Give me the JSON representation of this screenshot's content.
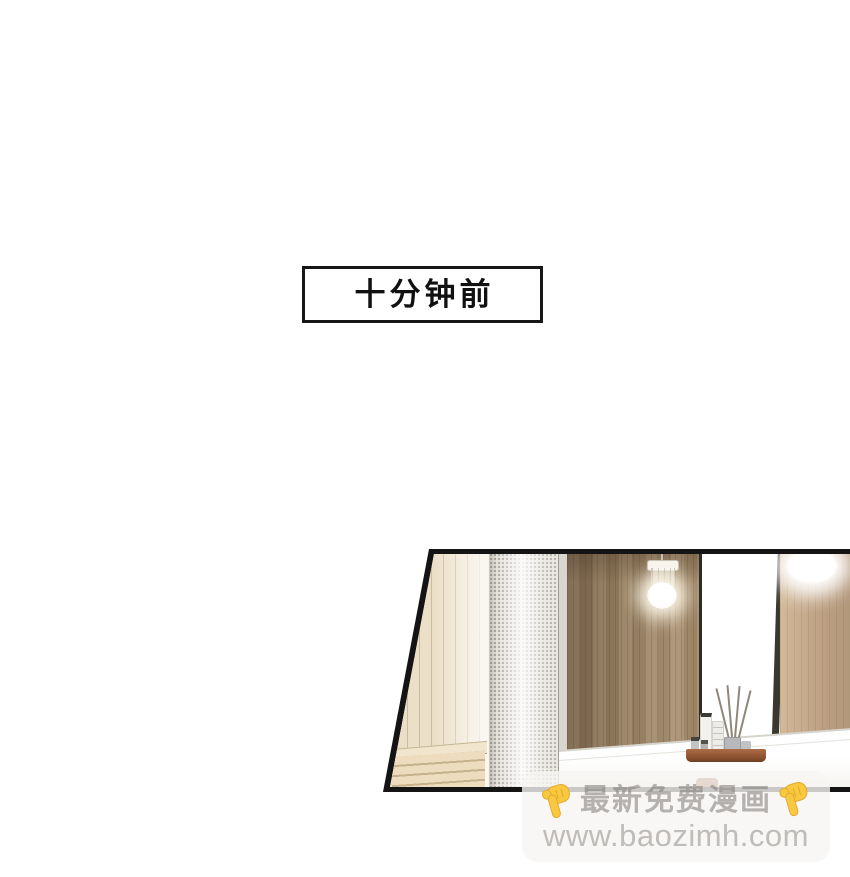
{
  "caption": {
    "text": "十分钟前"
  },
  "panel": {
    "shape": "trapezoid",
    "border_color": "#141414",
    "palette": {
      "light_wood": "#ecdfc8",
      "dark_wood": "#97805f",
      "mirror_wood": "#c9b091",
      "mesh_screen": "#e8e5df",
      "counter": "#fdfdfc",
      "tray": "#96583a",
      "frame": "#32302a"
    }
  },
  "watermark": {
    "line1": "最新免费漫画",
    "line2": "www.baozimh.com",
    "hand_icon_color": "#f8c83f",
    "text_color": "#a9a6a1"
  }
}
